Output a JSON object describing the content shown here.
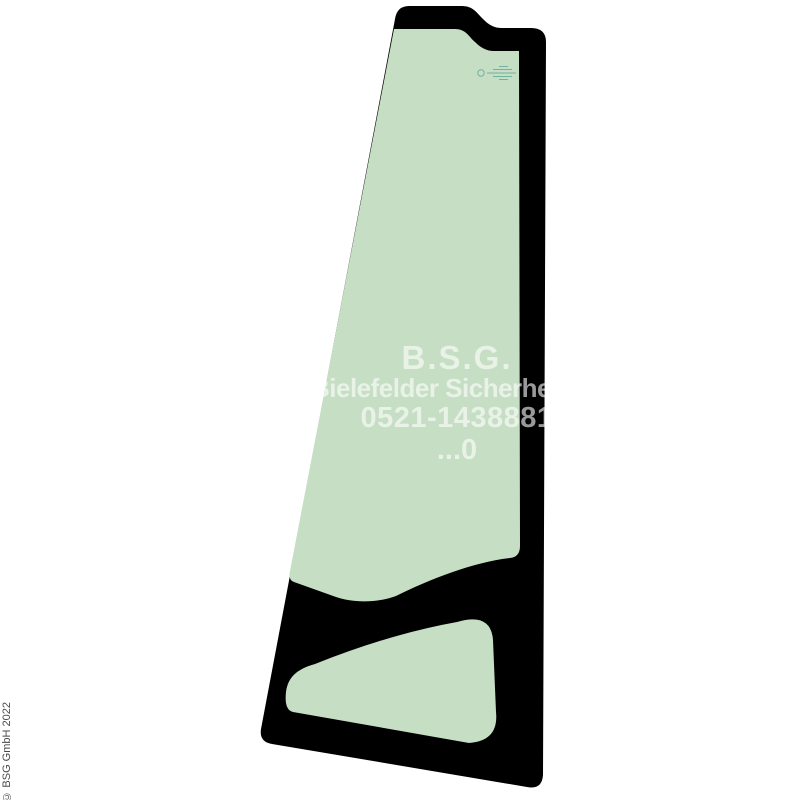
{
  "colors": {
    "background": "#ffffff",
    "seal_frame": "#000000",
    "glass": "#c6dec4",
    "stamp": "#5da99a",
    "watermark": "rgba(255,255,255,0.6)",
    "copyright": "#4a4a4a"
  },
  "watermark": {
    "lines": [
      "B.S.G.",
      "Bielefelder Sicherheits",
      "0521-1438881",
      "...0"
    ]
  },
  "copyright": "© BSG GmbH 2022"
}
